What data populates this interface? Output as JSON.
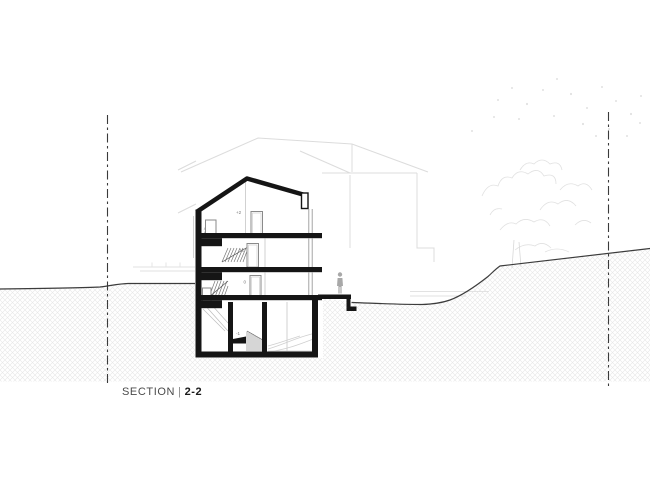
{
  "title": {
    "prefix": "SECTION",
    "separator": "|",
    "number": "2-2"
  },
  "levels": {
    "attic": "+2",
    "first": "+1",
    "ground": "0",
    "basement": "-1"
  },
  "colors": {
    "ink": "#1a1a1a",
    "cut_black": "#151515",
    "ground_line": "#3c3c3c",
    "background_gray": "#dcdcdc",
    "hatch_gray": "#e7e7e7",
    "label_gray": "#4a4a4a"
  }
}
